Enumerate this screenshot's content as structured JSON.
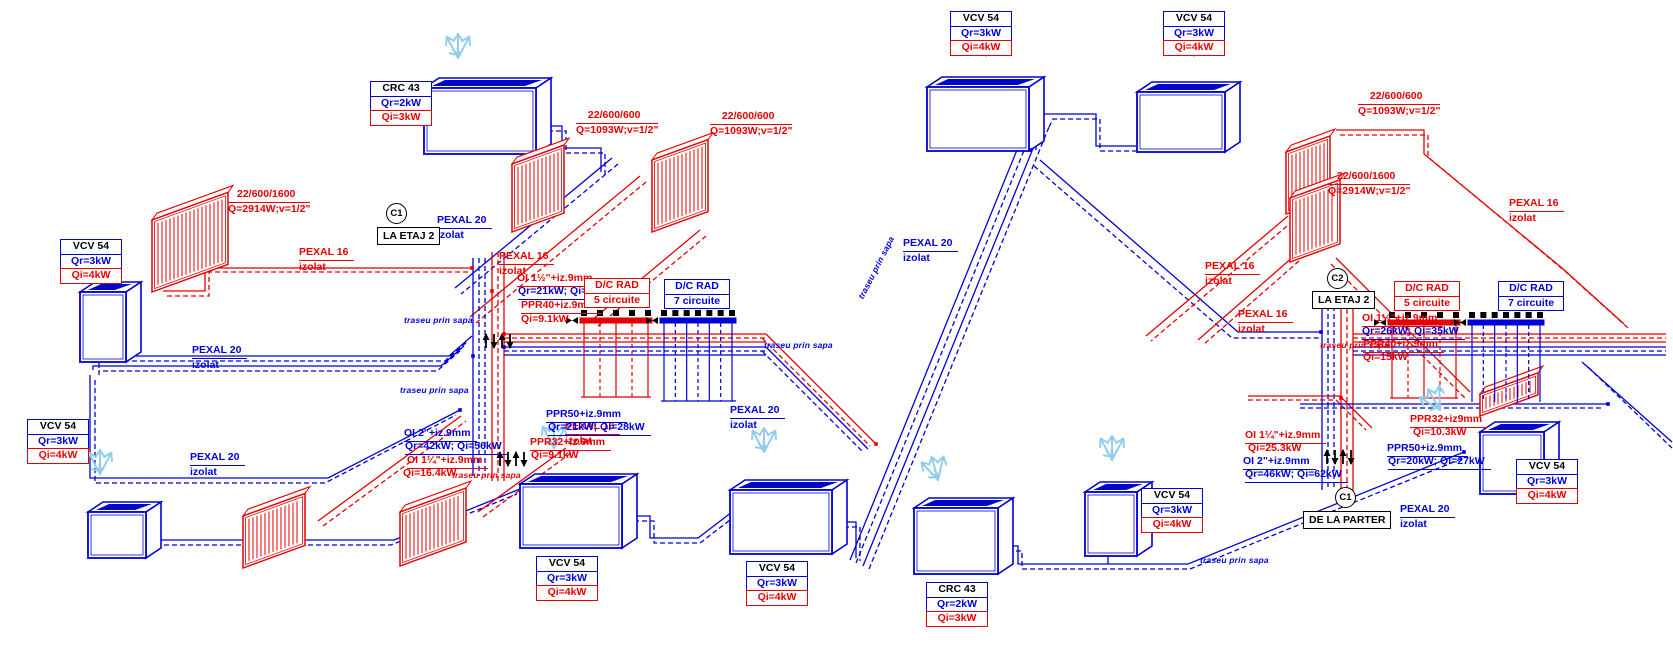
{
  "diagram_type": "heating-installation-isometric-scheme",
  "palette": {
    "red": "#e60000",
    "blue": "#0000d8",
    "light_blue": "#93cdec",
    "black": "#000000"
  },
  "unit_boxes": [
    {
      "t": "CRC 43",
      "qr": "Qr=2kW",
      "qi": "Qi=3kW",
      "x": 370,
      "y": 82
    },
    {
      "t": "VCV 54",
      "qr": "Qr=3kW",
      "qi": "Qi=4kW",
      "x": 60,
      "y": 240
    },
    {
      "t": "VCV 54",
      "qr": "Qr=3kW",
      "qi": "Qi=4kW",
      "x": 27,
      "y": 420
    },
    {
      "t": "VCV 54",
      "qr": "Qr=3kW",
      "qi": "Qi=4kW",
      "x": 536,
      "y": 557
    },
    {
      "t": "VCV 54",
      "qr": "Qr=3kW",
      "qi": "Qi=4kW",
      "x": 746,
      "y": 562
    },
    {
      "t": "VCV 54",
      "qr": "Qr=3kW",
      "qi": "Qi=4kW",
      "x": 950,
      "y": 12
    },
    {
      "t": "VCV 54",
      "qr": "Qr=3kW",
      "qi": "Qi=4kW",
      "x": 1163,
      "y": 12
    },
    {
      "t": "VCV 54",
      "qr": "Qr=3kW",
      "qi": "Qi=4kW",
      "x": 1141,
      "y": 489
    },
    {
      "t": "VCV 54",
      "qr": "Qr=3kW",
      "qi": "Qi=4kW",
      "x": 1516,
      "y": 460
    },
    {
      "t": "CRC 43",
      "qr": "Qr=2kW",
      "qi": "Qi=3kW",
      "x": 926,
      "y": 583
    }
  ],
  "dc_boxes": [
    {
      "l1": "D/C RAD",
      "l2": "5 circuite",
      "c": "red",
      "x": 584,
      "y": 279
    },
    {
      "l1": "D/C RAD",
      "l2": "7 circuite",
      "c": "blue",
      "x": 664,
      "y": 280
    },
    {
      "l1": "D/C RAD",
      "l2": "5 circuite",
      "c": "red",
      "x": 1394,
      "y": 282
    },
    {
      "l1": "D/C RAD",
      "l2": "7 circuite",
      "c": "blue",
      "x": 1498,
      "y": 282
    }
  ],
  "nodes": [
    {
      "label": "C1",
      "caption": "LA ETAJ 2",
      "cx": 396,
      "cy": 213,
      "bx": 377,
      "by": 227
    },
    {
      "label": "C2",
      "caption": "LA ETAJ 2",
      "cx": 1337,
      "cy": 278,
      "bx": 1312,
      "by": 291
    },
    {
      "label": "C1",
      "caption": "DE LA PARTER",
      "cx": 1345,
      "cy": 497,
      "bx": 1303,
      "by": 511
    }
  ],
  "pipe_labels": [
    {
      "x": 576,
      "y": 109,
      "c": "red",
      "align": "center",
      "lines": [
        {
          "t": "22/600/600",
          "u": 1
        },
        {
          "t": "Q=1093W;v=1/2\""
        }
      ]
    },
    {
      "x": 710,
      "y": 110,
      "c": "red",
      "align": "center",
      "lines": [
        {
          "t": "22/600/600",
          "u": 1
        },
        {
          "t": "Q=1093W;v=1/2\""
        }
      ]
    },
    {
      "x": 228,
      "y": 188,
      "c": "red",
      "align": "center",
      "lines": [
        {
          "t": "22/600/1600",
          "u": 1
        },
        {
          "t": "Q=2914W;v=1/2\""
        }
      ]
    },
    {
      "x": 299,
      "y": 246,
      "c": "red",
      "lines": [
        {
          "t": "PEXAL 16",
          "u": 1
        },
        {
          "t": "izolat"
        }
      ]
    },
    {
      "x": 437,
      "y": 214,
      "c": "blue",
      "lines": [
        {
          "t": "PEXAL 20",
          "u": 1
        },
        {
          "t": "izolat"
        }
      ]
    },
    {
      "x": 499,
      "y": 250,
      "c": "red",
      "lines": [
        {
          "t": "PEXAL 16",
          "u": 1
        },
        {
          "t": "izolat"
        }
      ]
    },
    {
      "x": 192,
      "y": 344,
      "c": "blue",
      "lines": [
        {
          "t": "PEXAL 20",
          "u": 1
        },
        {
          "t": "izolat"
        }
      ]
    },
    {
      "x": 190,
      "y": 451,
      "c": "blue",
      "lines": [
        {
          "t": "PEXAL 20",
          "u": 1
        },
        {
          "t": "izolat"
        }
      ]
    },
    {
      "x": 565,
      "y": 420,
      "c": "red",
      "lines": [
        {
          "t": "PEXAL 16",
          "u": 1
        },
        {
          "t": "izolat"
        }
      ]
    },
    {
      "x": 730,
      "y": 404,
      "c": "blue",
      "lines": [
        {
          "t": "PEXAL 20",
          "u": 1
        },
        {
          "t": "izolat"
        }
      ]
    },
    {
      "x": 517,
      "y": 272,
      "c": "red",
      "lines": [
        {
          "t": "OI 1½\"+iz.9mm",
          "u": 1
        }
      ]
    },
    {
      "x": 518,
      "y": 285,
      "c": "blue",
      "lines": [
        {
          "t": "Qr=21kW; Qi=28kW",
          "u": 1
        }
      ]
    },
    {
      "x": 521,
      "y": 299,
      "c": "red",
      "lines": [
        {
          "t": "PPR40+iz.9mm",
          "u": 1
        }
      ]
    },
    {
      "x": 521,
      "y": 313,
      "c": "red",
      "lines": [
        {
          "t": "Qi=9.1kW"
        }
      ]
    },
    {
      "x": 404,
      "y": 427,
      "c": "blue",
      "lines": [
        {
          "t": "OI 2\"+iz.9mm",
          "u": 1
        }
      ]
    },
    {
      "x": 405,
      "y": 440,
      "c": "blue",
      "lines": [
        {
          "t": "Qr=42kW; Qi=56kW",
          "u": 1
        }
      ]
    },
    {
      "x": 407,
      "y": 454,
      "c": "red",
      "lines": [
        {
          "t": "OI 1¼\"+iz.9mm",
          "u": 1
        }
      ]
    },
    {
      "x": 403,
      "y": 467,
      "c": "red",
      "lines": [
        {
          "t": "Qi=16.4kW"
        }
      ]
    },
    {
      "x": 546,
      "y": 408,
      "c": "blue",
      "lines": [
        {
          "t": "PPR50+iz.9mm",
          "u": 1
        }
      ]
    },
    {
      "x": 548,
      "y": 421,
      "c": "blue",
      "lines": [
        {
          "t": "Qr=21kW; Qi=28kW",
          "u": 1
        }
      ]
    },
    {
      "x": 530,
      "y": 436,
      "c": "red",
      "lines": [
        {
          "t": "PPR32+iz.9mm",
          "u": 1
        }
      ]
    },
    {
      "x": 531,
      "y": 449,
      "c": "red",
      "lines": [
        {
          "t": "Qi=9.1kW"
        }
      ]
    },
    {
      "x": 1358,
      "y": 90,
      "c": "red",
      "align": "center",
      "lines": [
        {
          "t": "22/600/600",
          "u": 1
        },
        {
          "t": "Q=1093W;v=1/2\""
        }
      ]
    },
    {
      "x": 1328,
      "y": 170,
      "c": "red",
      "align": "center",
      "lines": [
        {
          "t": "22/600/1600",
          "u": 1
        },
        {
          "t": "Q=2914W;v=1/2\""
        }
      ]
    },
    {
      "x": 1509,
      "y": 197,
      "c": "red",
      "lines": [
        {
          "t": "PEXAL 16",
          "u": 1
        },
        {
          "t": "izolat"
        }
      ]
    },
    {
      "x": 903,
      "y": 237,
      "c": "blue",
      "lines": [
        {
          "t": "PEXAL 20",
          "u": 1
        },
        {
          "t": "izolat"
        }
      ]
    },
    {
      "x": 1205,
      "y": 260,
      "c": "red",
      "lines": [
        {
          "t": "PEXAL 16",
          "u": 1
        },
        {
          "t": "izolat"
        }
      ]
    },
    {
      "x": 1238,
      "y": 308,
      "c": "red",
      "lines": [
        {
          "t": "PEXAL 16",
          "u": 1
        },
        {
          "t": "izolat"
        }
      ]
    },
    {
      "x": 1362,
      "y": 312,
      "c": "red",
      "lines": [
        {
          "t": "OI 1½\"+iz.9mm",
          "u": 1
        }
      ]
    },
    {
      "x": 1362,
      "y": 325,
      "c": "blue",
      "lines": [
        {
          "t": "Qr=26kW; Qi=35kW",
          "u": 1
        }
      ]
    },
    {
      "x": 1363,
      "y": 338,
      "c": "red",
      "lines": [
        {
          "t": "PPR40+iz.9mm",
          "u": 1
        }
      ]
    },
    {
      "x": 1363,
      "y": 351,
      "c": "red",
      "lines": [
        {
          "t": "Qi=15kW"
        }
      ]
    },
    {
      "x": 1245,
      "y": 429,
      "c": "red",
      "lines": [
        {
          "t": "OI 1¼\"+iz.9mm",
          "u": 1
        }
      ]
    },
    {
      "x": 1248,
      "y": 442,
      "c": "red",
      "lines": [
        {
          "t": "Qi=25.3kW"
        }
      ]
    },
    {
      "x": 1243,
      "y": 455,
      "c": "blue",
      "lines": [
        {
          "t": "OI 2\"+iz.9mm",
          "u": 1
        }
      ]
    },
    {
      "x": 1245,
      "y": 468,
      "c": "blue",
      "lines": [
        {
          "t": "Qr=46kW; Qi=62kW",
          "u": 1
        }
      ]
    },
    {
      "x": 1410,
      "y": 413,
      "c": "red",
      "lines": [
        {
          "t": "PPR32+iz9mm",
          "u": 1
        }
      ]
    },
    {
      "x": 1413,
      "y": 426,
      "c": "red",
      "lines": [
        {
          "t": "Qi=10.3kW"
        }
      ]
    },
    {
      "x": 1387,
      "y": 442,
      "c": "blue",
      "lines": [
        {
          "t": "PPR50+iz.9mm",
          "u": 1
        }
      ]
    },
    {
      "x": 1388,
      "y": 455,
      "c": "blue",
      "lines": [
        {
          "t": "Qr=20kW; Qi=27kW",
          "u": 1
        }
      ]
    },
    {
      "x": 1400,
      "y": 503,
      "c": "blue",
      "lines": [
        {
          "t": "PEXAL 20",
          "u": 1
        },
        {
          "t": "izolat"
        }
      ]
    },
    {
      "x": 404,
      "y": 315,
      "c": "blue",
      "note": 1,
      "lines": [
        {
          "t": "traseu prin sapa"
        }
      ]
    },
    {
      "x": 400,
      "y": 385,
      "c": "blue",
      "note": 1,
      "lines": [
        {
          "t": "traseu prin sapa"
        }
      ]
    },
    {
      "x": 452,
      "y": 470,
      "c": "red",
      "note": 1,
      "lines": [
        {
          "t": "traseu prin sapa"
        }
      ]
    },
    {
      "x": 764,
      "y": 340,
      "c": "blue",
      "note": 1,
      "lines": [
        {
          "t": "traseu prin sapa"
        }
      ]
    },
    {
      "x": 856,
      "y": 296,
      "c": "blue",
      "note": 1,
      "rot": -63,
      "lines": [
        {
          "t": "traseu prin sapa"
        }
      ]
    },
    {
      "x": 1320,
      "y": 340,
      "c": "red",
      "note": 1,
      "lines": [
        {
          "t": "traseu prin sapa"
        }
      ]
    },
    {
      "x": 1200,
      "y": 555,
      "c": "blue",
      "note": 1,
      "lines": [
        {
          "t": "traseu prin sapa"
        }
      ]
    }
  ]
}
